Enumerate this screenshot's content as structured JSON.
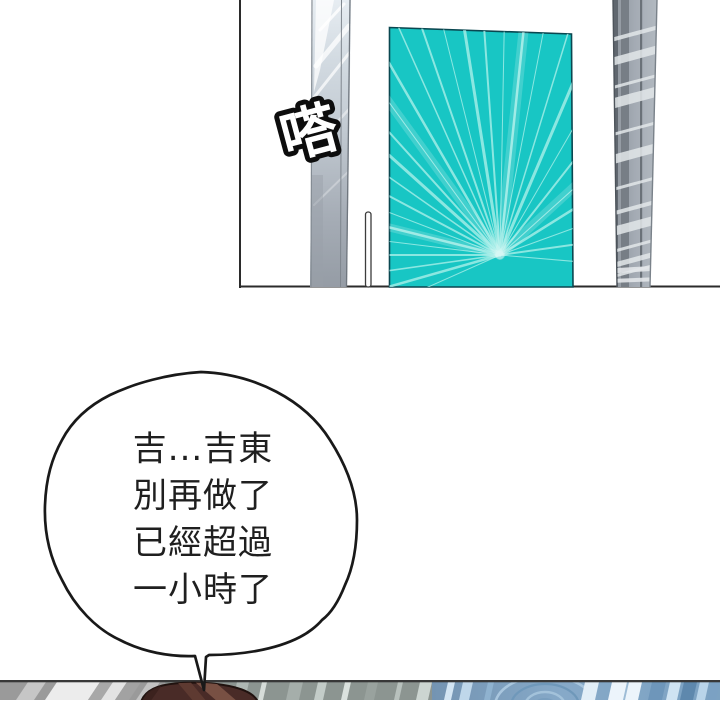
{
  "panel_top": {
    "sfx": "嗒"
  },
  "speech_bubble": {
    "lines": [
      "吉...吉東",
      "別再做了",
      "已經超過",
      "一小時了"
    ]
  },
  "theme": {
    "ink": "#191919",
    "panel-border": "#2b2b2b",
    "door-teal": "#18c6c4",
    "door-ray": "#a9efe9",
    "door-edge": "#0a4750",
    "pillar-left-light": "#e7edf2",
    "pillar-left-dark": "#959ca5",
    "pillar-right-base": "#9aa2ab",
    "pillar-right-dark": "#60676f",
    "stripe-light": "#e2e6e9",
    "bubble-text": "#1f1f1f",
    "hair-dark": "#492b27",
    "hair-light": "#7b5244",
    "floor-gray": "#9a9a9a",
    "floor-sage": "#8c9591",
    "floor-blue": "#7b9cbc"
  }
}
